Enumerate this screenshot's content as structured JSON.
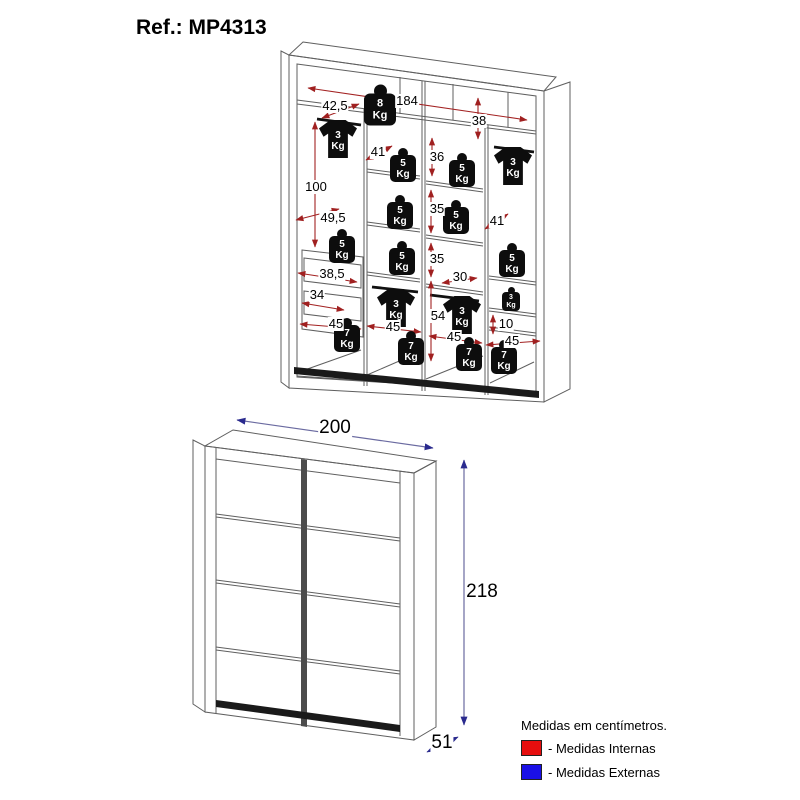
{
  "title": "Ref.: MP4313",
  "interior": {
    "dims": [
      {
        "text": "42,5"
      },
      {
        "text": "184"
      },
      {
        "text": "38"
      },
      {
        "text": "41"
      },
      {
        "text": "36"
      },
      {
        "text": "100"
      },
      {
        "text": "49,5"
      },
      {
        "text": "35"
      },
      {
        "text": "41"
      },
      {
        "text": "35"
      },
      {
        "text": "38,5"
      },
      {
        "text": "30"
      },
      {
        "text": "34"
      },
      {
        "text": "45"
      },
      {
        "text": "45"
      },
      {
        "text": "54"
      },
      {
        "text": "45"
      },
      {
        "text": "10"
      },
      {
        "text": "45"
      }
    ],
    "weights": [
      {
        "value": "8",
        "unit": "Kg"
      },
      {
        "value": "5",
        "unit": "Kg"
      },
      {
        "value": "5",
        "unit": "Kg"
      },
      {
        "value": "5",
        "unit": "Kg"
      },
      {
        "value": "5",
        "unit": "Kg"
      },
      {
        "value": "5",
        "unit": "Kg"
      },
      {
        "value": "5",
        "unit": "Kg"
      },
      {
        "value": "5",
        "unit": "Kg"
      },
      {
        "value": "3",
        "unit": "Kg"
      },
      {
        "value": "7",
        "unit": "Kg"
      },
      {
        "value": "7",
        "unit": "Kg"
      },
      {
        "value": "7",
        "unit": "Kg"
      },
      {
        "value": "7",
        "unit": "Kg"
      }
    ],
    "shirts": [
      {
        "value": "3",
        "unit": "Kg"
      },
      {
        "value": "3",
        "unit": "Kg"
      },
      {
        "value": "3",
        "unit": "Kg"
      },
      {
        "value": "3",
        "unit": "Kg"
      }
    ]
  },
  "exterior": {
    "dims": [
      {
        "text": "200"
      },
      {
        "text": "218"
      },
      {
        "text": "51"
      }
    ]
  },
  "legend": {
    "note": "Medidas em centímetros.",
    "items": [
      {
        "label": "- Medidas Internas",
        "color": "#e60e0e"
      },
      {
        "label": "- Medidas Externas",
        "color": "#1a10e6"
      }
    ]
  },
  "colors": {
    "internal_arrow": "#a32222",
    "external_arrow": "#2c2c96",
    "line": "#5f5f5f"
  }
}
